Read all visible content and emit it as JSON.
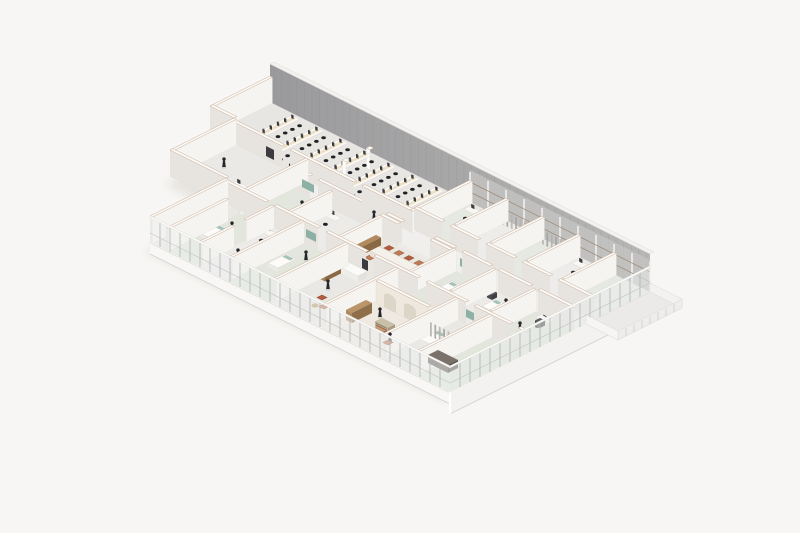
{
  "scene": {
    "description": "Isometric cutaway rendering of a clinic office floor plan",
    "palette": {
      "background": "#f7f6f4",
      "shadow": "#ddd9d4",
      "floorBase": "#edebe8",
      "outline": "#d9d6d1",
      "wallFaceSE": "#e7e4e0",
      "wallFaceSW": "#f6f4f1",
      "wallTop": "#fbfaf8",
      "wallEdge": "#c9ae96",
      "neWallA": "#9a999b",
      "neWallB": "#b7b6b6",
      "neStripe": "#8f8e90",
      "neLight": "#c6c5c3",
      "columnWhite": "#f1f0ee",
      "railBrown": "#9c8672",
      "glass": "#eef1f1",
      "glassSE": "#e9eced",
      "mullion": "#b2b0ac",
      "fascia": "#f8f7f5",
      "fasciaSE": "#f3f2f0",
      "fasciaEdge": "#d5d2cd",
      "deskTop": "#f9f7f4",
      "deskEdge": "#d8d2c9",
      "deskGlow": "#e9d8b6",
      "chairDark": "#232327",
      "monitorDark": "#3b3b40",
      "figure": "#26262a",
      "teal": "#86aba0",
      "tealSoft": "#9dbbb1",
      "chairRed": "#af5d3e",
      "chairRedAlt": "#bd7a55",
      "wood": "#a8815a",
      "woodDark": "#8a6844",
      "woodLight": "#c09a6b",
      "cream": "#efe8de",
      "creamDark": "#ddd5c8",
      "curtain": "#aeacaa",
      "equipDark": "#4a4a4e",
      "sage": "#e2e6dc"
    },
    "iso": {
      "origin": [
        270,
        102
      ]
    },
    "footprint": [
      [
        0,
        0
      ],
      [
        190,
        0
      ],
      [
        190,
        100
      ],
      [
        40,
        100
      ],
      [
        40,
        62
      ],
      [
        12,
        62
      ],
      [
        12,
        30
      ],
      [
        0,
        30
      ]
    ],
    "rooms": [
      {
        "id": "open-office",
        "r": [
          0,
          0,
          100,
          30
        ],
        "f": "#e8e6e3"
      },
      {
        "id": "north-room-1",
        "r": [
          100,
          0,
          118,
          28
        ],
        "f": "#e6e9e2"
      },
      {
        "id": "north-room-2",
        "r": [
          118,
          0,
          136,
          28
        ],
        "f": "#edecea"
      },
      {
        "id": "north-room-3",
        "r": [
          136,
          0,
          154,
          28
        ],
        "f": "#e6e9e2"
      },
      {
        "id": "north-room-4",
        "r": [
          154,
          0,
          172,
          28
        ],
        "f": "#edecea"
      },
      {
        "id": "north-room-5",
        "r": [
          172,
          0,
          190,
          28
        ],
        "f": "#e6e9e2"
      },
      {
        "id": "corridor-east",
        "r": [
          100,
          28,
          190,
          38
        ],
        "f": "#f0efed"
      },
      {
        "id": "corridor-west",
        "r": [
          48,
          30,
          100,
          38
        ],
        "f": "#f0efed"
      },
      {
        "id": "multipurpose-room",
        "r": [
          12,
          30,
          48,
          62
        ],
        "f": "#ebe9e6"
      },
      {
        "id": "consult-room-1",
        "r": [
          48,
          38,
          70,
          62
        ],
        "f": "#e2e6dc"
      },
      {
        "id": "consult-room-2",
        "r": [
          70,
          38,
          95,
          62
        ],
        "f": "#ecebe8"
      },
      {
        "id": "break-room",
        "r": [
          95,
          40,
          130,
          62
        ],
        "f": "#eae6e0"
      },
      {
        "id": "treatment-room-1",
        "r": [
          130,
          38,
          150,
          62
        ],
        "f": "#e2e6dc"
      },
      {
        "id": "treatment-room-2",
        "r": [
          150,
          38,
          170,
          62
        ],
        "f": "#ecebe8"
      },
      {
        "id": "treatment-room-3",
        "r": [
          170,
          38,
          190,
          62
        ],
        "f": "#e2e6dc"
      },
      {
        "id": "store-room",
        "r": [
          40,
          62,
          48,
          100
        ],
        "f": "#e9e8e5"
      },
      {
        "id": "exam-room-1",
        "r": [
          48,
          62,
          63,
          100
        ],
        "f": "#e2e6dc"
      },
      {
        "id": "exam-room-2",
        "r": [
          63,
          62,
          78,
          100
        ],
        "f": "#ecebe8"
      },
      {
        "id": "exam-room-3",
        "r": [
          78,
          62,
          100,
          100
        ],
        "f": "#e2e6dc"
      },
      {
        "id": "work-room",
        "r": [
          100,
          62,
          125,
          100
        ],
        "f": "#eae8e4"
      },
      {
        "id": "lobby",
        "r": [
          125,
          62,
          155,
          100
        ],
        "f": "#efe9e1"
      },
      {
        "id": "bay-room",
        "r": [
          155,
          62,
          172,
          100
        ],
        "f": "#e9e8e5"
      },
      {
        "id": "utility-room",
        "r": [
          172,
          62,
          190,
          100
        ],
        "f": "#e2e6dc"
      }
    ],
    "wallsExterior": [
      [
        0,
        0,
        0,
        30
      ],
      [
        0,
        30,
        12,
        30
      ],
      [
        12,
        30,
        12,
        62
      ],
      [
        12,
        62,
        40,
        62
      ],
      [
        40,
        62,
        40,
        100
      ]
    ],
    "wallsInterior": [
      [
        12,
        30,
        36,
        30
      ],
      [
        40,
        30,
        72,
        30
      ],
      [
        76,
        30,
        100,
        30
      ],
      [
        100,
        0,
        100,
        30
      ],
      [
        118,
        0,
        118,
        26
      ],
      [
        136,
        0,
        136,
        26
      ],
      [
        154,
        0,
        154,
        26
      ],
      [
        172,
        0,
        172,
        26
      ],
      [
        100,
        28,
        114,
        28
      ],
      [
        118,
        28,
        132,
        28
      ],
      [
        136,
        28,
        150,
        28
      ],
      [
        154,
        28,
        168,
        28
      ],
      [
        172,
        28,
        190,
        28
      ],
      [
        48,
        38,
        58,
        38
      ],
      [
        62,
        38,
        92,
        38
      ],
      [
        96,
        38,
        104,
        38
      ],
      [
        120,
        38,
        130,
        38
      ],
      [
        134,
        38,
        148,
        38
      ],
      [
        152,
        38,
        168,
        38
      ],
      [
        172,
        38,
        190,
        38
      ],
      [
        48,
        30,
        48,
        64
      ],
      [
        48,
        70,
        48,
        100
      ],
      [
        70,
        40,
        70,
        62
      ],
      [
        95,
        40,
        95,
        62
      ],
      [
        130,
        38,
        130,
        62
      ],
      [
        150,
        38,
        150,
        60
      ],
      [
        170,
        38,
        170,
        60
      ],
      [
        95,
        40,
        104,
        40
      ],
      [
        120,
        40,
        130,
        40
      ],
      [
        40,
        62,
        60,
        62
      ],
      [
        64,
        62,
        86,
        62
      ],
      [
        90,
        62,
        110,
        62
      ],
      [
        114,
        62,
        136,
        62
      ],
      [
        140,
        62,
        160,
        62
      ],
      [
        164,
        62,
        182,
        62
      ],
      [
        186,
        62,
        190,
        62
      ],
      [
        63,
        62,
        63,
        76
      ],
      [
        63,
        82,
        63,
        98
      ],
      [
        78,
        62,
        78,
        98
      ],
      [
        100,
        62,
        100,
        98
      ],
      [
        125,
        62,
        125,
        98
      ],
      [
        155,
        62,
        155,
        98
      ],
      [
        172,
        62,
        172,
        98
      ]
    ],
    "archWall": {
      "v": 74,
      "u1": 127,
      "u2": 153,
      "h": 22,
      "arches": [
        [
          131,
          137
        ],
        [
          141,
          147
        ]
      ]
    },
    "deskRows": {
      "u": [
        16,
        28,
        40,
        52,
        64,
        76,
        88
      ],
      "v1": 3,
      "v2": 27
    },
    "pillars": [
      [
        58,
        8
      ],
      [
        58,
        20
      ]
    ],
    "furniture": [
      {
        "t": "ws",
        "p": [
          33,
          50
        ]
      },
      {
        "t": "ws",
        "p": [
          104,
          4
        ]
      },
      {
        "t": "ws",
        "p": [
          158,
          4
        ]
      },
      {
        "t": "ws",
        "p": [
          72,
          42
        ]
      },
      {
        "t": "ws",
        "p": [
          64,
          66
        ]
      },
      {
        "t": "ws",
        "p": [
          176,
          40
        ]
      },
      {
        "t": "btable",
        "r": [
          102,
          47.5,
          124,
          52
        ]
      },
      {
        "t": "chair",
        "p": [
          104,
          44.5
        ],
        "c": "#af5d3e"
      },
      {
        "t": "chair",
        "p": [
          109,
          44.5
        ],
        "c": "#bd7a55"
      },
      {
        "t": "chair",
        "p": [
          114,
          44.5
        ],
        "c": "#af5d3e"
      },
      {
        "t": "chair",
        "p": [
          119,
          44.5
        ],
        "c": "#bd7a55"
      },
      {
        "t": "chair",
        "p": [
          104,
          54
        ],
        "c": "#bd7a55"
      },
      {
        "t": "chair",
        "p": [
          109,
          54
        ],
        "c": "#af5d3e"
      },
      {
        "t": "chair",
        "p": [
          114,
          54
        ],
        "c": "#bd7a55"
      },
      {
        "t": "chair",
        "p": [
          119,
          54
        ],
        "c": "#af5d3e"
      },
      {
        "t": "chair",
        "p": [
          126,
          49.5
        ],
        "c": "#af5d3e"
      },
      {
        "t": "chair",
        "p": [
          112,
          86
        ],
        "c": "#af5d3e"
      },
      {
        "t": "chair",
        "p": [
          117,
          90
        ],
        "c": "#bd7a55"
      },
      {
        "t": "chair",
        "p": [
          146,
          88
        ],
        "c": "#af5d3e"
      },
      {
        "t": "chair",
        "p": [
          151,
          92
        ],
        "c": "#bd7a55"
      },
      {
        "t": "rtable",
        "p": [
          114.5,
          92
        ]
      },
      {
        "t": "bed",
        "p": [
          50,
          76
        ]
      },
      {
        "t": "bed",
        "p": [
          82,
          74
        ]
      },
      {
        "t": "bed",
        "p": [
          158,
          74
        ]
      },
      {
        "t": "rec",
        "p": [
          137,
          46
        ]
      },
      {
        "t": "rec",
        "p": [
          157,
          44
        ]
      },
      {
        "t": "block",
        "r": [
          97,
          44,
          99.5,
          58
        ],
        "h": 8,
        "c": [
          "#b28a5e",
          "#a8815a",
          "#8a6844"
        ]
      },
      {
        "t": "block",
        "r": [
          101,
          68,
          103.5,
          76
        ],
        "h": 9,
        "c": [
          "#b28a5e",
          "#a8815a",
          "#8a6844"
        ]
      },
      {
        "t": "block",
        "r": [
          128,
          80,
          131,
          90
        ],
        "h": 10,
        "c": [
          "#bb9468",
          "#b08a5e",
          "#8f6f4a"
        ]
      },
      {
        "t": "dshelf",
        "r": [
          140,
          84,
          146.5,
          87.5
        ],
        "h": 8
      },
      {
        "t": "block",
        "r": [
          98,
          63.5,
          112,
          68
        ],
        "h": 6,
        "c": [
          "#fafaf8",
          "#efedea",
          "#e5e2dd"
        ]
      },
      {
        "t": "block",
        "r": [
          170,
          86,
          180,
          91
        ],
        "h": 8,
        "c": [
          "#7a726a",
          "#6b635b",
          "#575049"
        ]
      },
      {
        "t": "equip",
        "p": [
          66,
          40
        ]
      },
      {
        "t": "equip",
        "p": [
          152,
          41
        ]
      },
      {
        "t": "equip",
        "p": [
          178,
          43
        ]
      },
      {
        "t": "board",
        "p": [
          54,
          38
        ],
        "w": 6
      },
      {
        "t": "board",
        "p": [
          133,
          38
        ],
        "w": 5
      },
      {
        "t": "board",
        "p": [
          80,
          62
        ],
        "w": 5
      },
      {
        "t": "board",
        "p": [
          160,
          62
        ],
        "w": 5
      },
      {
        "t": "panel",
        "p": [
          28,
          30
        ],
        "w": 4
      },
      {
        "t": "panel",
        "p": [
          74,
          38
        ],
        "w": 3.5
      },
      {
        "t": "panel",
        "p": [
          119,
          28
        ],
        "w": 3
      },
      {
        "t": "panel",
        "p": [
          146,
          62
        ],
        "w": 3.5
      },
      {
        "t": "panel",
        "p": [
          108,
          62
        ],
        "w": 3
      },
      {
        "t": "panel",
        "p": [
          166,
          38
        ],
        "w": 3.5
      },
      {
        "t": "curtains",
        "p": [
          158,
          78
        ],
        "dir": "u",
        "len": 16
      },
      {
        "t": "curtains",
        "p": [
          120,
          4
        ],
        "dir": "u",
        "len": 12
      },
      {
        "t": "curtains",
        "p": [
          140,
          4
        ],
        "dir": "u",
        "len": 10
      },
      {
        "t": "curtains",
        "p": [
          84,
          66
        ],
        "dir": "v",
        "len": 10
      }
    ],
    "figures": [
      [
        21,
        44
      ],
      [
        14,
        24
      ],
      [
        37,
        56
      ],
      [
        62,
        46
      ],
      [
        55,
        74
      ],
      [
        70,
        86
      ],
      [
        88,
        70
      ],
      [
        112,
        56
      ],
      [
        108,
        79
      ],
      [
        135,
        80
      ],
      [
        150,
        90
      ],
      [
        162,
        44
      ],
      [
        177,
        52
      ],
      [
        120,
        33
      ],
      [
        85,
        33
      ]
    ],
    "neWall": {
      "u1": 0,
      "u2": 190,
      "h": 38,
      "lightFrom": 100,
      "stripeStep": 3.8,
      "colStep": 9
    },
    "glassSW": {
      "v": 100,
      "u1": 40,
      "u2": 190,
      "h": 24,
      "fasciaH": 12
    },
    "glassSE": {
      "u": 190,
      "v1": 0,
      "v2": 100,
      "h": 24,
      "fasciaH": 22
    },
    "terrace": {
      "r": [
        190,
        0,
        206,
        32
      ],
      "h": 9,
      "floor": "#eceae8"
    }
  }
}
